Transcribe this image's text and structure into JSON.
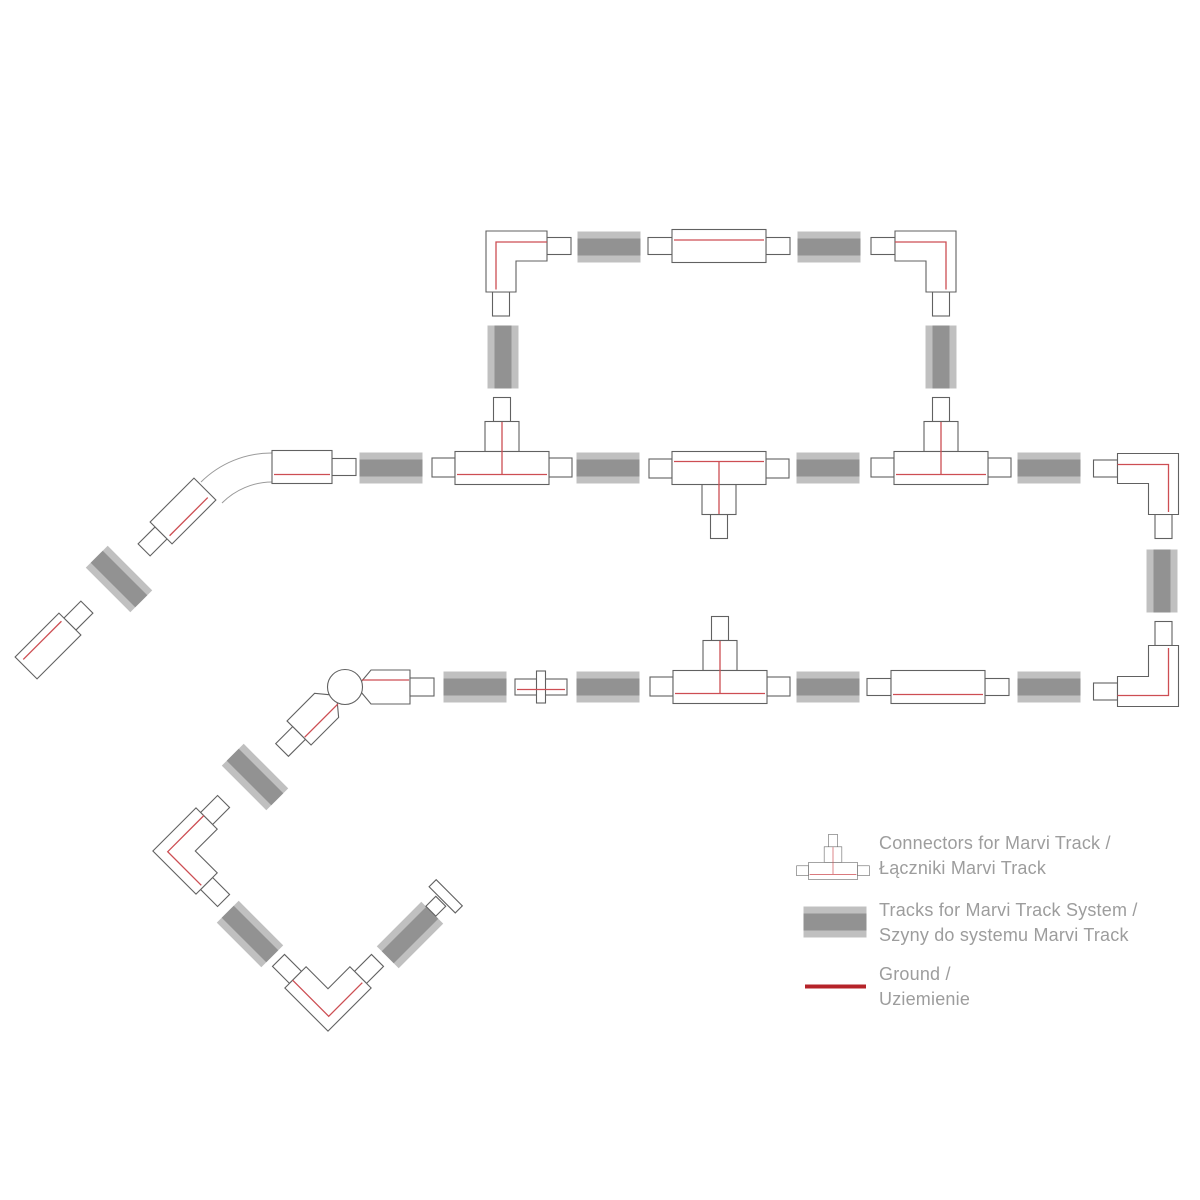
{
  "page": {
    "title": "Marvi Track System layout diagram",
    "background": "#ffffff",
    "width": 1200,
    "height": 1200
  },
  "colors": {
    "track_light": "#c0c0c0",
    "track_dark": "#929292",
    "outline": "#616161",
    "ground": "#cd4e53",
    "ground_bold": "#b52329",
    "curve_outline": "#9a9a9a",
    "connector_fill": "#ffffff",
    "legend_text": "#9d9d9d"
  },
  "legend": {
    "items": [
      {
        "icon": "t-connector-icon",
        "line1": "Connectors for Marvi Track /",
        "line2": "Łączniki Marvi Track"
      },
      {
        "icon": "track-icon",
        "line1": "Tracks for Marvi Track System /",
        "line2": "Szyny do systemu Marvi Track"
      },
      {
        "icon": "ground-line-icon",
        "line1": "Ground /",
        "line2": "Uziemienie"
      }
    ]
  },
  "diagram": {
    "pieces": [
      {
        "t": "curve"
      },
      {
        "t": "track",
        "x": 609,
        "y": 247
      },
      {
        "t": "track",
        "x": 829,
        "y": 247
      },
      {
        "t": "track",
        "x": 503,
        "y": 357,
        "r": 90
      },
      {
        "t": "track",
        "x": 941,
        "y": 357,
        "r": 90
      },
      {
        "t": "track",
        "x": 391,
        "y": 468
      },
      {
        "t": "track",
        "x": 608,
        "y": 468
      },
      {
        "t": "track",
        "x": 828,
        "y": 468
      },
      {
        "t": "track",
        "x": 1049,
        "y": 468
      },
      {
        "t": "track",
        "x": 1162,
        "y": 581,
        "r": 90
      },
      {
        "t": "track",
        "x": 475,
        "y": 687
      },
      {
        "t": "track",
        "x": 608,
        "y": 687
      },
      {
        "t": "track",
        "x": 828,
        "y": 687
      },
      {
        "t": "track",
        "x": 1049,
        "y": 687
      },
      {
        "t": "track",
        "x": 119,
        "y": 579,
        "r": 45
      },
      {
        "t": "track",
        "x": 255,
        "y": 777,
        "r": 45
      },
      {
        "t": "track",
        "x": 250,
        "y": 934,
        "r": 45
      },
      {
        "t": "track",
        "x": 410,
        "y": 935,
        "r": -45
      },
      {
        "t": "l",
        "x": 516.5,
        "y": 261.5,
        "o": "tl"
      },
      {
        "t": "l",
        "x": 925.5,
        "y": 261.5,
        "o": "tr"
      },
      {
        "t": "l",
        "x": 1148,
        "y": 484,
        "o": "tr"
      },
      {
        "t": "l",
        "x": 1148,
        "y": 676,
        "o": "br"
      },
      {
        "t": "l",
        "x": 196,
        "y": 851,
        "o": "tl",
        "r": -45
      },
      {
        "t": "l",
        "x": 328,
        "y": 988,
        "o": "br",
        "r": 45
      },
      {
        "t": "t",
        "x": 502,
        "y": 468,
        "v": "up"
      },
      {
        "t": "t",
        "x": 719,
        "y": 468,
        "v": "down"
      },
      {
        "t": "t",
        "x": 941,
        "y": 468,
        "v": "up"
      },
      {
        "t": "t",
        "x": 720,
        "y": 687,
        "v": "up"
      },
      {
        "t": "straight",
        "x": 719,
        "y": 246,
        "redge": "top"
      },
      {
        "t": "straight",
        "x": 938,
        "y": 687,
        "redge": "bottom"
      },
      {
        "t": "straight",
        "x": 302,
        "y": 467,
        "redge": "bottom",
        "w": 60,
        "stubs": "right"
      },
      {
        "t": "end",
        "x": 48,
        "y": 646,
        "r": -45,
        "stub": 1,
        "redy": -8
      },
      {
        "t": "end",
        "x": 183,
        "y": 511,
        "r": -45,
        "stub": -1,
        "redy": 8
      },
      {
        "t": "ball",
        "x": 345,
        "y": 687
      },
      {
        "t": "mini",
        "x": 541,
        "y": 687
      },
      {
        "t": "cap",
        "x": 445,
        "y": 897,
        "r": -45
      },
      {
        "t": "t",
        "x": 833,
        "y": 871,
        "v": "up",
        "s": 0.52,
        "n": "legend-t-connector-icon"
      },
      {
        "t": "track",
        "x": 835,
        "y": 922,
        "n": "legend-track-icon"
      },
      {
        "t": "gline",
        "x": 835.5,
        "y": 986.5,
        "w": 61,
        "h": 4,
        "n": "legend-ground-line-icon"
      }
    ]
  }
}
